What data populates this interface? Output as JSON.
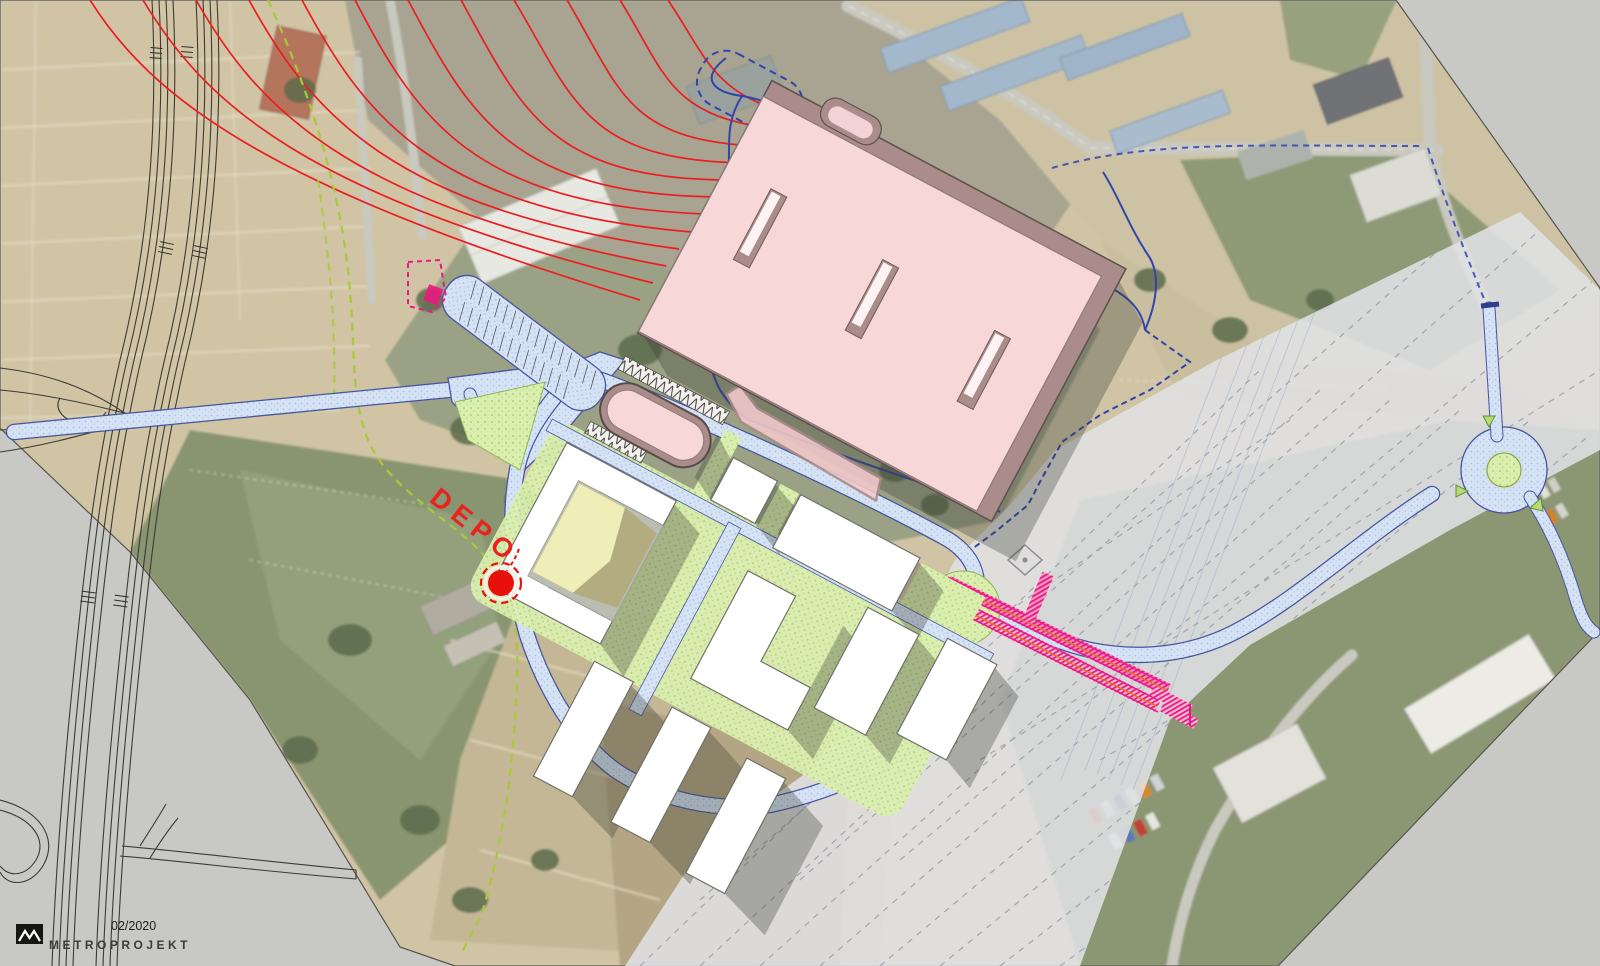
{
  "annotations": {
    "depot_label": "DEPO",
    "date_label": "02/2020",
    "company_label": "METROPROJEKT"
  },
  "colors": {
    "paper_gray": "#c8c9c4",
    "depot_roof_pink": "#f8d7d9",
    "depot_wall_mauve": "#aa8d8b",
    "road_fill_blue": "#d6e3f5",
    "road_edge_navy": "#46549f",
    "landscape_green": "#daeeb0",
    "rail_overlay_gray": "#e0e1e5",
    "metro_track_magenta": "#ea1982",
    "track_axis_orange": "#e0762a",
    "alignment_red": "#ec1d20",
    "site_boundary_green": "#a9c93a",
    "cadastral_blue": "#3243ae",
    "marker_red": "#e8100c",
    "label_red": "#e8231e",
    "logo_black": "#151513"
  }
}
